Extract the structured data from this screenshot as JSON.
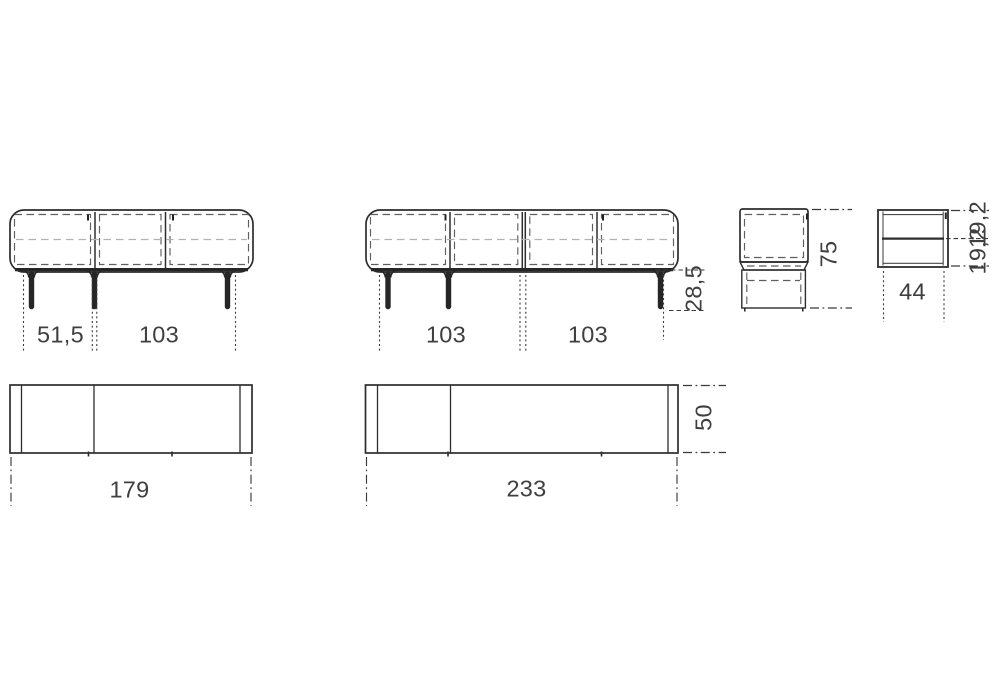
{
  "style": {
    "background": "#ffffff",
    "line_color": "#2d2d2d",
    "dashed_line_color": "#5f5f5f",
    "shelf_line_color": "#b2b2b2",
    "text_color": "#3f3f3f"
  },
  "views": {
    "sideboard_a_front": {
      "description": "3-door sideboard front elevation",
      "dim_left": "51,5",
      "dim_right": "103"
    },
    "sideboard_b_front": {
      "description": "4-door sideboard front elevation",
      "dim_left": "103",
      "dim_right": "103",
      "dim_leg_height": "28,5"
    },
    "side_view": {
      "description": "sideboard side elevation",
      "dim_height": "75"
    },
    "module_detail": {
      "description": "module side section detail",
      "dim_width": "44",
      "dim_upper": "19,2",
      "dim_lower": "19,2"
    },
    "plan_a": {
      "description": "small sideboard top plan",
      "dim_width": "179"
    },
    "plan_b": {
      "description": "large sideboard top plan",
      "dim_width": "233",
      "dim_depth": "50"
    }
  }
}
